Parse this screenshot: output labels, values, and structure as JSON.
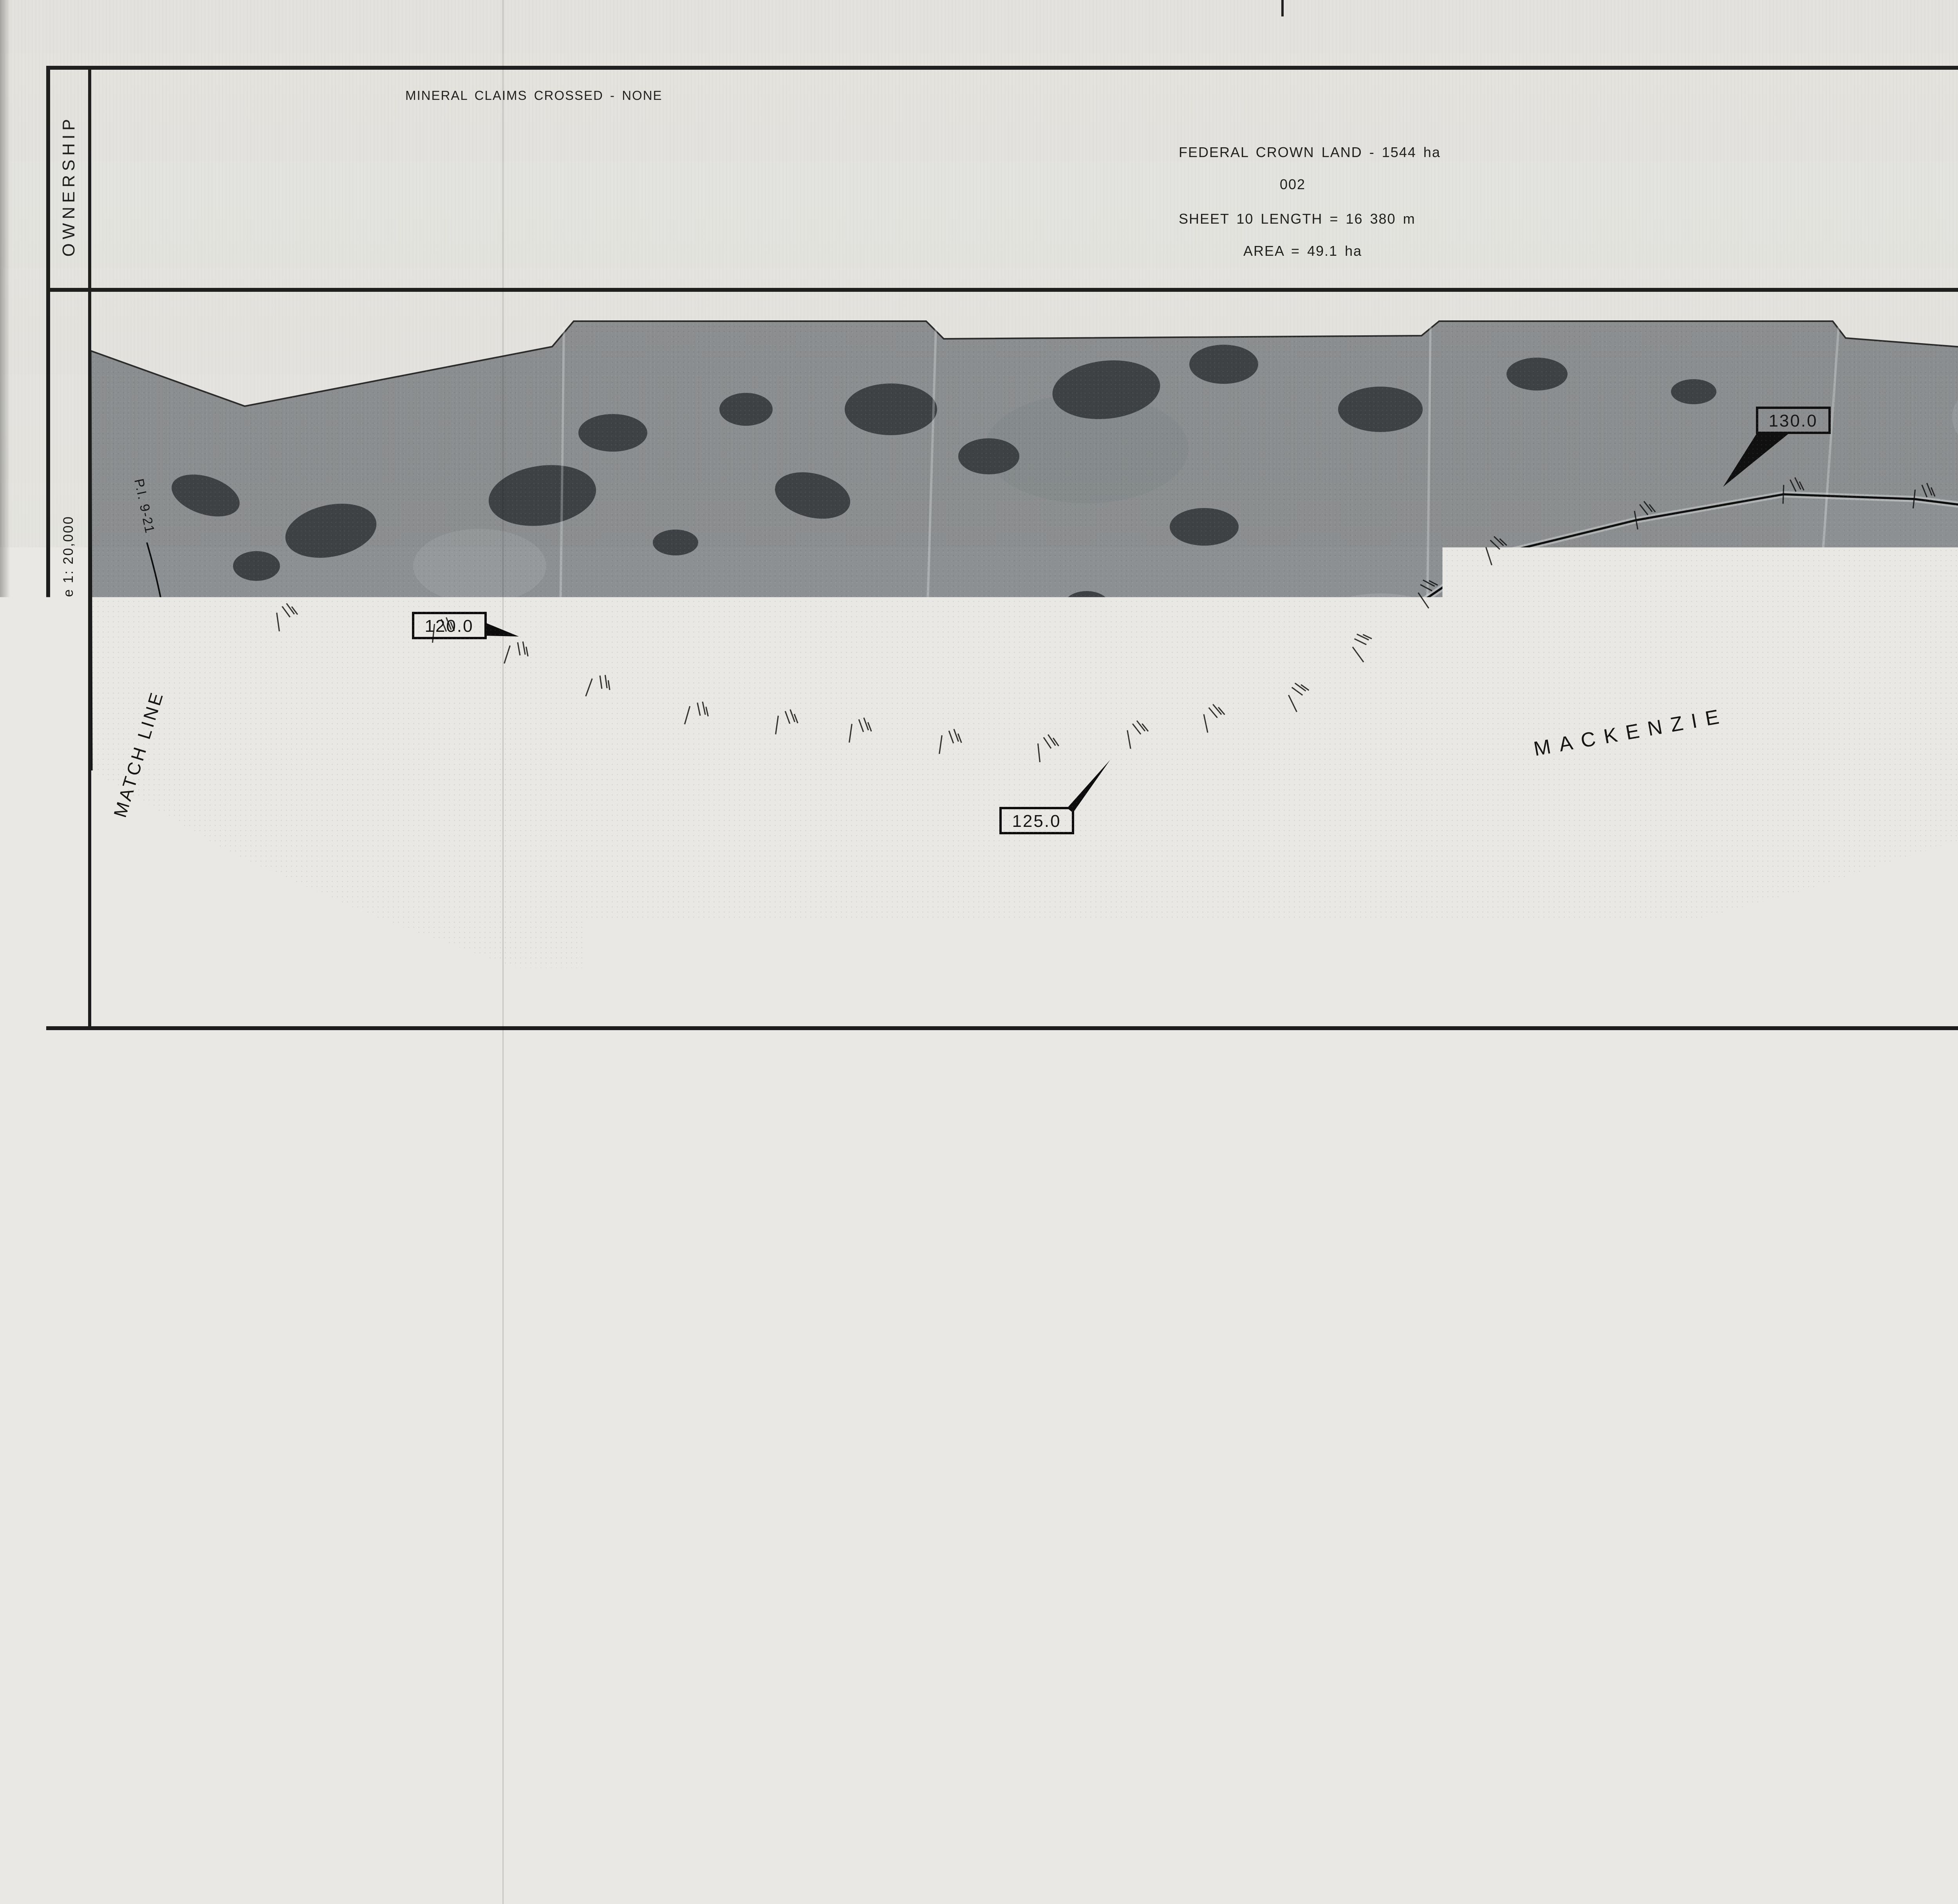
{
  "ownership": {
    "label": "OWNERSHIP",
    "mineral_note": "MINERAL  CLAIMS  CROSSED  -  NONE",
    "crown_land": "FEDERAL  CROWN  LAND  - 1544  ha",
    "parcel": "002",
    "length_note": "SHEET  10   LENGTH  =  16 380  m",
    "area_note": "AREA      =  49.1   ha"
  },
  "sheet_no": {
    "word": "SHEET",
    "number": "10",
    "of_word": "of",
    "total": "55"
  },
  "plan": {
    "label": "PLAN",
    "scale_label": "Scale   1: 20,000",
    "match_line_left": "MATCH  LINE",
    "match_line_right": "MATCH  LINE",
    "river_word1": "MACKENZIE",
    "river_word2": "RIVER",
    "pi_label": "P.I. 9-21",
    "km_post_1": "120.0",
    "km_post_2": "125.0",
    "km_post_3": "130.0"
  },
  "key_plan": {
    "title": "KEY  PLAN  n.t.s.",
    "north": "N",
    "norman1": "NORMAN",
    "norman2": "WELLS",
    "great_bear": "Great  Bear  Lake",
    "keele": "Keele  R",
    "redstone": "Redstone  R",
    "wrigley": "WRIGLEY",
    "mackenzie": "Mackenzie",
    "mackenzie_r": "R",
    "willowlake": "Willowlake   R",
    "fort1": "FORT",
    "fort2": "SIMPSON",
    "liard": "Liard   R",
    "nwt_n": "N",
    "nwt_w": "W",
    "nwt_t": "T",
    "yukon_letters": [
      "Y",
      "U",
      "K",
      "O",
      "N"
    ],
    "bc_b": "B",
    "bc_c": "C",
    "alta": "ALTA",
    "zama1": "Zama",
    "zama2": "Lake",
    "gsl1": "Great",
    "gsl2": "Slave  Lake",
    "sixty": "60°",
    "mile_ticks": [
      "1",
      "10",
      "20",
      "30",
      "40",
      "50",
      "55"
    ]
  },
  "row_detail": {
    "title": "RIGHT-OF-WAY  DETAIL",
    "subtitle": "NOT  TO  SCALE",
    "boundary_top": "R.O.W.  Boundary",
    "boundary_bottom": "R.O.W.  Boundary",
    "pipeline": "PIPELINE",
    "dim_total": "30 m",
    "dim_top": "15 m",
    "dim_bottom": "15 m"
  },
  "clsr_stamp": {
    "title": "CANADA LANDS SURVEYS RECORDS",
    "digits": [
      "6",
      "8",
      "1",
      "9",
      "8"
    ],
    "date_label": "Date",
    "date_day": "18",
    "date_month": "JUNE",
    "date_year": "1982"
  },
  "title_block": {
    "line1": "PLAN  AND  FIELD  NOTES  OF  CENTRE  LINE  OF",
    "line2": "30  METRE  PIPELINE  RIGHT - OF - WAY",
    "line3": "FOR  INTERPROVINCIAL  PIPE  LINE  (NW)  LTD.  THROUGH",
    "line4": "PART  OF  THE  NORTHWEST  TERRITORIES",
    "scale_label": "SCALE",
    "scale_value": "1 :  20 000",
    "bar_labels": [
      "500",
      "0",
      "500",
      "1000",
      "1500",
      "2000"
    ],
    "survey_note1": "THIS  SURVEY  WAS  EXECUTED  DURING  THE  PERIOD  MARCH  10,  1981  TO  JUNE  30,  1982",
    "survey_note2": "BY  VICTOR  WOLCHANSKY  C.L.S"
  },
  "legend": {
    "title": "LEGEND  :",
    "item1": "C.L.S.  posts  found  shown  thus",
    "item2": "Square  Iron  bars  13 mm  by  45 cm  or  30 cm  spikes  shown  thus",
    "item3": "Centre  line  of  pipeline  is  shown  thus",
    "item4": "Lands  dealt  with  by  this  plan  bounded  thus  ( see  detail )",
    "item5": "Distances  are  in  metres  and  decimals  thereof .",
    "item6": "Pipeline  right - of - way  is  30 m  wide  unless  shown  otherwise .",
    "sym1": "◎",
    "sym2": "●"
  },
  "affidavit": {
    "line1": "I ,  Victor  Wolchansky  of  the  City  of  Edmonton ,  Canada  Lands  Surveyor ,",
    "line2": "make  oath  and  say  that  I  have  in  my  own  proper  person ,  according  to  law",
    "line3": "and  the  instructions  of  the  Surveyor  General  of  Canada  Lands ,  faithfully",
    "line4": "and  correctly  executed  the  survey  shown  by  this  plan  and  field  notes ,",
    "line5": "and  that  the  said  plan  and  field  notes  are  correct  and  true  to  the  best",
    "line6": "of  my  knowledge  and  belief",
    "line7": "SO  HELP  ME  GOD ."
  },
  "sworn": {
    "line1": "Sworn  before  me  at  the",
    "line2": "City  of  Edmonton",
    "pre": "this",
    "day": "19",
    "mid": "day of",
    "month": "July",
    "year": ",  1982"
  },
  "signatures": {
    "cls_label_right": "Canada  Lands  Surveyor",
    "mayne": "Robert E Mayne",
    "cls_label_left": "Canada  Lands  Surveyor"
  },
  "footer": {
    "signing1": "Signing on behalf of",
    "signing2": "Interprovincial  Pipe Line ( NW )  LTD.",
    "signing3": "Holder of Certificate of Public Convenience",
    "signing4": "and Necessity No. OC - 35",
    "copy1a": "A Copy of this plan is",
    "copy1b": "filed",
    "copy2a": "in the",
    "copy2b": "Land Titles",
    "copy2c": "Office",
    "copy3": "at Yellowknife as 1559 - 10",
    "dept1_name": "Department of Indian Affairs and Northern Development",
    "dept1_city": "Ottawa",
    "dept1_date": "September 9",
    "dept1_year": ", 1982",
    "dept1_re": "Re : Section 43 Canada Lands Surveys Act",
    "dept1_note": "This survey and plan are satisfactory",
    "dept1_sig": "D. C. Evans",
    "dept1_for": "for",
    "dept1_role": "Minister",
    "dept2_name": "Department of Energy Mines and Resources",
    "dept2_city": "Ottawa",
    "dept2_date": "24 September",
    "dept2_year": ", 1982",
    "dept2_re": "Re : Section 43 Canada Lands Surveys Act",
    "dept2_note1": "Confirmed insofar as Crown Canada Lands",
    "dept2_note2": "are affected .",
    "dept2_sig": "W. V. Blackie",
    "dept2_role": "Surveyor General",
    "note_item": "Item : 1-82 PL",
    "note_exmd": "Exmd : JMP 9/9/82",
    "note_corner": "OK 9/7"
  },
  "edge_stamp": {
    "title": "CANADA LANDS SURVEYS RECORDS",
    "number": "6 8 1 9 8"
  }
}
